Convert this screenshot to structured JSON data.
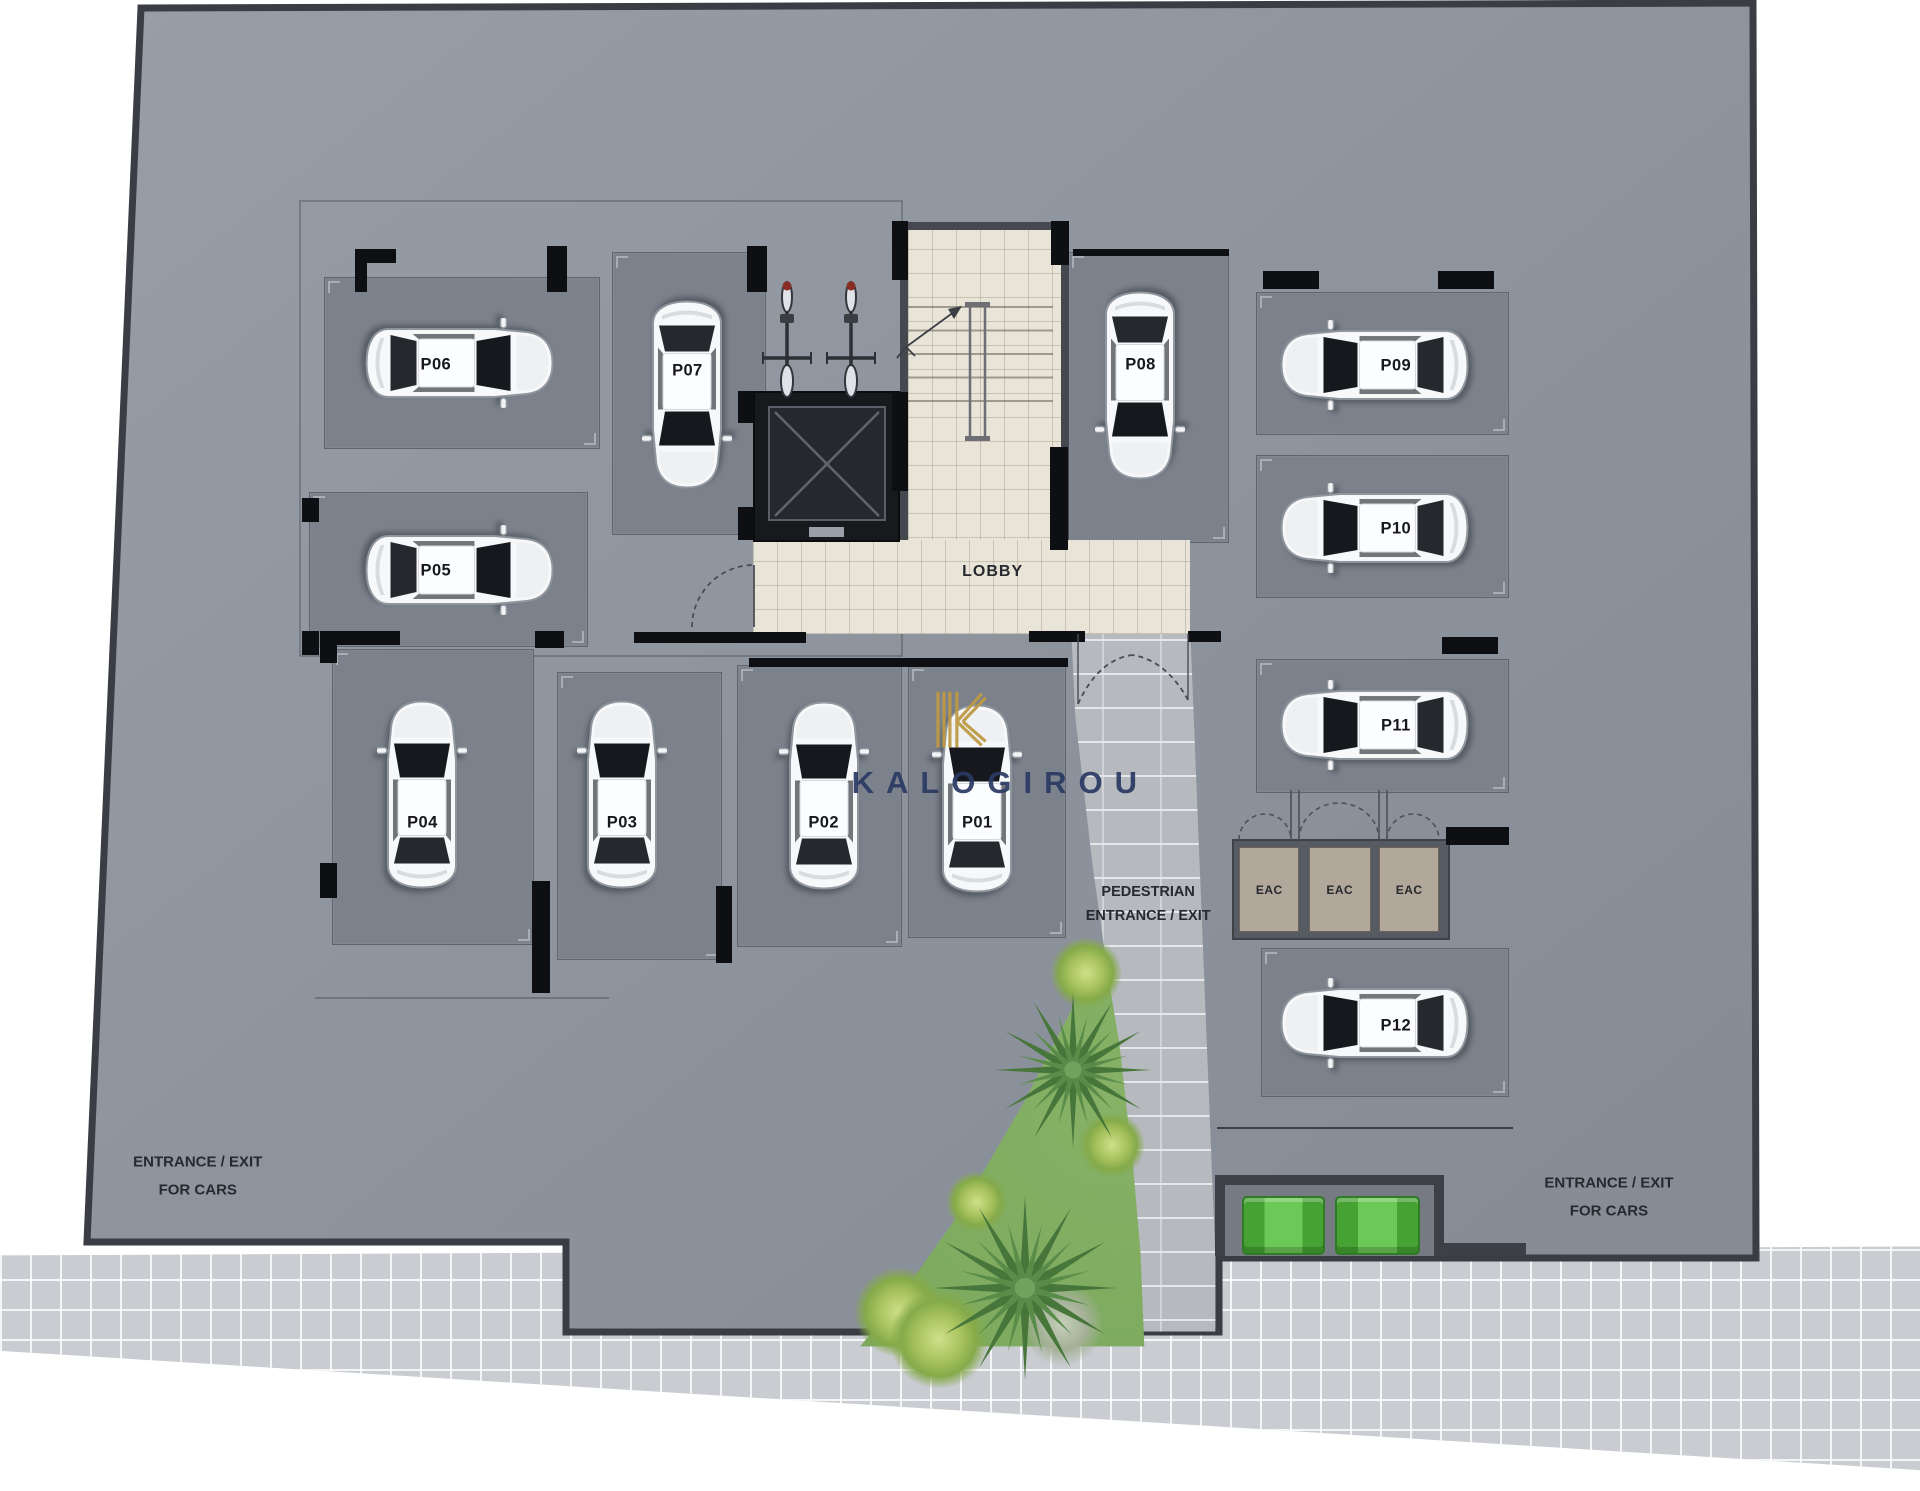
{
  "title": "Parking level floor plan",
  "watermark": {
    "monogram": "K",
    "brand": "KALOGIROU"
  },
  "lobby_label": "LOBBY",
  "pedestrian_entrance": {
    "line1": "PEDESTRIAN",
    "line2": "ENTRANCE / EXIT"
  },
  "car_entrance_left": {
    "line1": "ENTRANCE / EXIT",
    "line2": "FOR CARS"
  },
  "car_entrance_right": {
    "line1": "ENTRANCE / EXIT",
    "line2": "FOR CARS"
  },
  "parking_spots": [
    {
      "label": "P01"
    },
    {
      "label": "P02"
    },
    {
      "label": "P03"
    },
    {
      "label": "P04"
    },
    {
      "label": "P05"
    },
    {
      "label": "P06"
    },
    {
      "label": "P07"
    },
    {
      "label": "P08"
    },
    {
      "label": "P09"
    },
    {
      "label": "P10"
    },
    {
      "label": "P11"
    },
    {
      "label": "P12"
    }
  ],
  "eac_units": [
    {
      "label": "EAC"
    },
    {
      "label": "EAC"
    },
    {
      "label": "EAC"
    }
  ],
  "colors": {
    "plan_fill": "#8e949d",
    "plan_border": "#3a3e44",
    "spot_fill": "#7c828c",
    "floor_beige": "#e9e4d8",
    "path": "#b6b9be",
    "sidewalk": "#c9ccd1",
    "grass": "#6fa052",
    "bench_green": "#55b43f",
    "eac_fill": "#b2a79b",
    "watermark_gold": "#bd9a45",
    "watermark_navy": "#2b3a64"
  }
}
